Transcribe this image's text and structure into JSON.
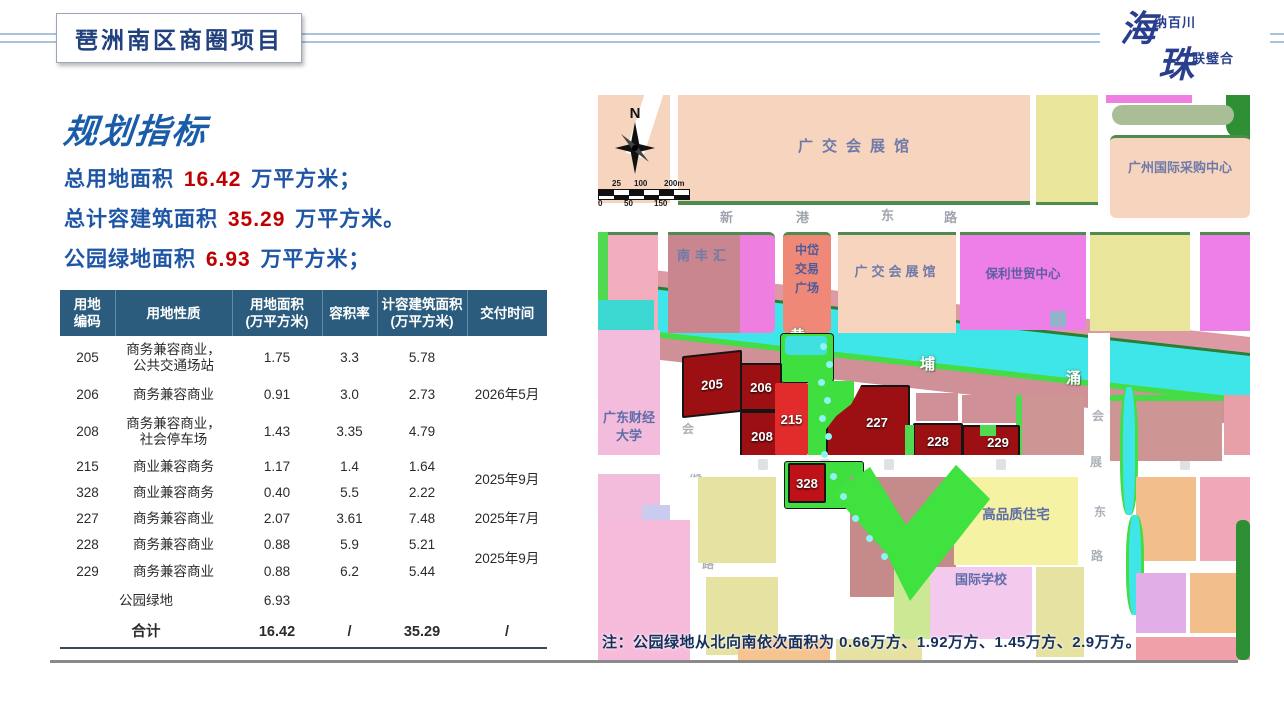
{
  "slide": {
    "title": "琶洲南区商圈项目"
  },
  "logo": {
    "char1": "海",
    "tag1": "纳百川",
    "char2": "珠",
    "tag2": "联璧合"
  },
  "left": {
    "heading": "规划指标",
    "kpis": [
      {
        "label": "总用地面积",
        "value": "16.42",
        "unit": "万平方米；"
      },
      {
        "label": "总计容建筑面积",
        "value": "35.29",
        "unit": "万平方米。"
      },
      {
        "label": "公园绿地面积",
        "value": "6.93",
        "unit": "万平方米；"
      }
    ],
    "table": {
      "headers": [
        "用地\n编码",
        "用地性质",
        "用地面积\n(万平方米)",
        "容积率",
        "计容建筑面积\n(万平方米)",
        "交付时间"
      ],
      "rows": [
        {
          "code": "205",
          "nature": "商务兼容商业，\n公共交通场站",
          "area": "1.75",
          "far": "3.3",
          "gfa": "5.78",
          "delivery": "2026年5月"
        },
        {
          "code": "206",
          "nature": "商务兼容商业",
          "area": "0.91",
          "far": "3.0",
          "gfa": "2.73"
        },
        {
          "code": "208",
          "nature": "商务兼容商业，\n社会停车场",
          "area": "1.43",
          "far": "3.35",
          "gfa": "4.79"
        },
        {
          "code": "215",
          "nature": "商业兼容商务",
          "area": "1.17",
          "far": "1.4",
          "gfa": "1.64",
          "delivery": "2025年9月"
        },
        {
          "code": "328",
          "nature": "商业兼容商务",
          "area": "0.40",
          "far": "5.5",
          "gfa": "2.22"
        },
        {
          "code": "227",
          "nature": "商务兼容商业",
          "area": "2.07",
          "far": "3.61",
          "gfa": "7.48",
          "delivery": "2025年7月"
        },
        {
          "code": "228",
          "nature": "商务兼容商业",
          "area": "0.88",
          "far": "5.9",
          "gfa": "5.21",
          "delivery": "2025年9月"
        },
        {
          "code": "229",
          "nature": "商务兼容商业",
          "area": "0.88",
          "far": "6.2",
          "gfa": "5.44"
        },
        {
          "code": "",
          "nature": "公园绿地",
          "area": "6.93",
          "far": "",
          "gfa": "",
          "delivery": ""
        },
        {
          "code": "",
          "nature": "合计",
          "area": "16.42",
          "far": "/",
          "gfa": "35.29",
          "delivery": "/"
        }
      ]
    }
  },
  "map": {
    "compass": "N",
    "scale_top": [
      "25",
      "100",
      "200m"
    ],
    "scale_bottom": [
      "0",
      "50",
      "150"
    ],
    "labels": {
      "canton_fair_north": "广交会展馆",
      "procurement": "广州国际采购中心",
      "nanfenghui": "南丰汇",
      "zhongdai": [
        "中岱",
        "交易",
        "广场"
      ],
      "canton_fair_south": "广交会展馆",
      "poly": "保利世贸中心",
      "university": [
        "广东财经",
        "大学"
      ],
      "housing": "高品质住宅",
      "school": "国际学校"
    },
    "roads": {
      "xingang": [
        "新",
        "港",
        "东",
        "路"
      ],
      "huizhan_west": [
        "会",
        "展",
        "西",
        "路"
      ],
      "huizhan_east": [
        "会",
        "展",
        "东",
        "路"
      ],
      "canal": [
        "黄",
        "埔",
        "涌"
      ]
    },
    "plots": [
      "205",
      "206",
      "208",
      "215",
      "227",
      "228",
      "229",
      "328"
    ],
    "note": "注：公园绿地从北向南依次面积为 0.66万方、1.92万方、1.45万方、2.9万方。"
  },
  "colors": {
    "title_blue": "#20407e",
    "heading_blue": "#1a5ca8",
    "body_blue": "#1e55a5",
    "number_red": "#c00000",
    "table_header_bg": "#2b5c7e",
    "note_navy": "#14305c",
    "plot_dark_red": "#9c1014",
    "plot_bright_red": "#e22c2c",
    "park_green": "#3fdf3f",
    "canal_cyan": "#3ee6e9"
  }
}
